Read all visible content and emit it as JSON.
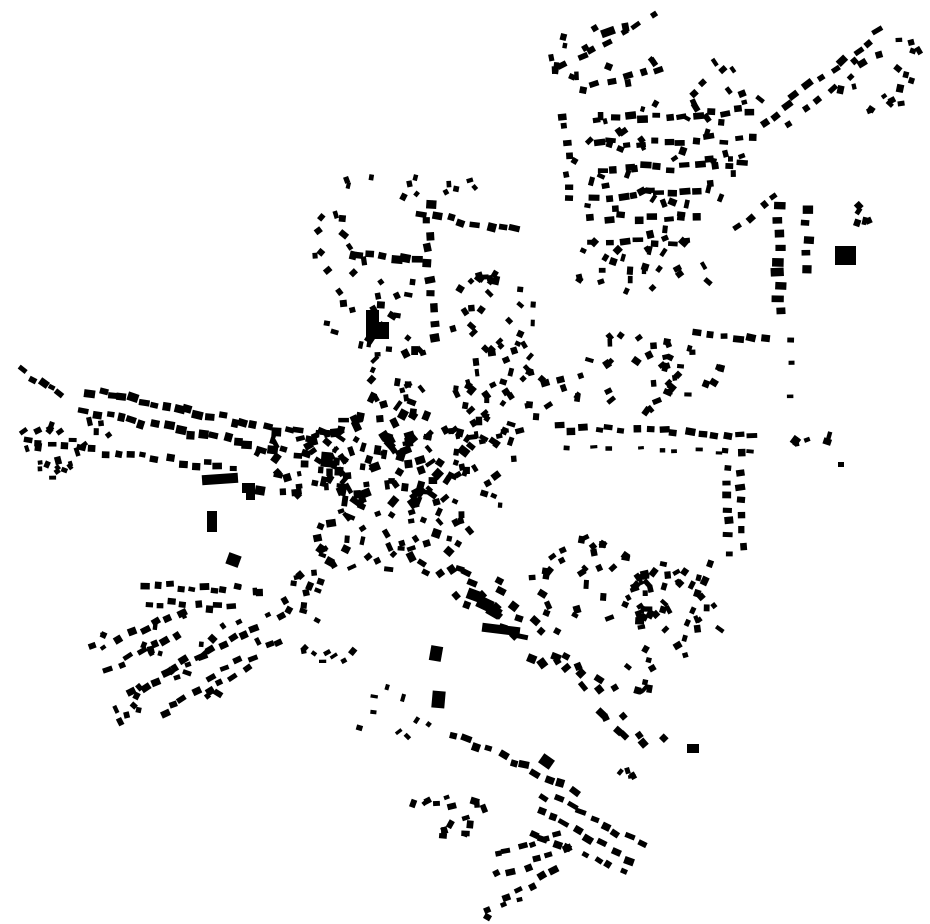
{
  "meta": {
    "title": "Figure-ground building footprint map",
    "canvas": {
      "width": 930,
      "height": 924
    },
    "colors": {
      "background": "#ffffff",
      "building": "#000000"
    },
    "seed": 20240707
  },
  "map": {
    "landmarks": [
      [
        366,
        310,
        13,
        14,
        0
      ],
      [
        366,
        322,
        23,
        17,
        0
      ],
      [
        835,
        246,
        21,
        19,
        0
      ],
      [
        202,
        474,
        36,
        10,
        -4
      ],
      [
        207,
        511,
        10,
        21,
        0
      ],
      [
        467,
        590,
        16,
        11,
        20
      ],
      [
        477,
        598,
        16,
        12,
        25
      ],
      [
        487,
        606,
        14,
        11,
        30
      ],
      [
        482,
        625,
        38,
        9,
        7
      ],
      [
        515,
        634,
        13,
        5,
        12
      ],
      [
        430,
        646,
        12,
        15,
        10
      ],
      [
        432,
        691,
        13,
        17,
        5
      ],
      [
        321,
        452,
        10,
        15,
        5
      ],
      [
        242,
        483,
        13,
        10,
        0
      ],
      [
        255,
        486,
        10,
        9,
        10
      ],
      [
        246,
        492,
        9,
        8,
        0
      ],
      [
        227,
        554,
        13,
        12,
        20
      ],
      [
        484,
        914,
        7,
        6,
        30
      ],
      [
        687,
        744,
        12,
        9,
        0
      ],
      [
        838,
        462,
        6,
        5,
        0
      ],
      [
        601,
        28,
        14,
        8,
        -20
      ],
      [
        540,
        756,
        13,
        11,
        35
      ]
    ],
    "streets": [
      {
        "p": [
          22,
          371,
          60,
          396
        ],
        "n": 5,
        "s": [
          8,
          6
        ]
      },
      {
        "p": [
          90,
          391,
          310,
          436
        ],
        "n": 21,
        "s": [
          9,
          7
        ]
      },
      {
        "p": [
          85,
          412,
          308,
          456
        ],
        "n": 20,
        "s": [
          9,
          7
        ]
      },
      {
        "p": [
          28,
          441,
          232,
          468
        ],
        "n": 17,
        "s": [
          8,
          6
        ]
      },
      {
        "p": [
          428,
          205,
          432,
          335
        ],
        "n": 10,
        "s": [
          8,
          9
        ],
        "jr": 14
      },
      {
        "p": [
          358,
          252,
          420,
          260
        ],
        "n": 6,
        "s": [
          9,
          7
        ]
      },
      {
        "p": [
          425,
          212,
          516,
          232
        ],
        "n": 8,
        "s": [
          9,
          7
        ]
      },
      {
        "p": [
          565,
          63,
          652,
          15
        ],
        "n": 7,
        "s": [
          8,
          6
        ]
      },
      {
        "p": [
          596,
          86,
          658,
          72
        ],
        "n": 5,
        "s": [
          8,
          6
        ]
      },
      {
        "p": [
          600,
          119,
          752,
          110
        ],
        "n": 12,
        "s": [
          9,
          6
        ]
      },
      {
        "p": [
          598,
          144,
          750,
          138
        ],
        "n": 12,
        "s": [
          9,
          6
        ]
      },
      {
        "p": [
          600,
          170,
          742,
          164
        ],
        "n": 11,
        "s": [
          9,
          6
        ]
      },
      {
        "p": [
          596,
          196,
          700,
          191
        ],
        "n": 9,
        "s": [
          9,
          6
        ]
      },
      {
        "p": [
          592,
          218,
          700,
          216
        ],
        "n": 8,
        "s": [
          9,
          6
        ]
      },
      {
        "p": [
          592,
          243,
          688,
          241
        ],
        "n": 7,
        "s": [
          9,
          6
        ]
      },
      {
        "p": [
          563,
          115,
          571,
          200
        ],
        "n": 7,
        "s": [
          7,
          7
        ]
      },
      {
        "p": [
          762,
          124,
          878,
          33
        ],
        "n": 11,
        "s": [
          9,
          6
        ]
      },
      {
        "p": [
          792,
          122,
          862,
          67
        ],
        "n": 6,
        "s": [
          8,
          6
        ]
      },
      {
        "p": [
          779,
          207,
          779,
          313
        ],
        "n": 9,
        "s": [
          11,
          7
        ],
        "perp": true,
        "jp": 2,
        "jr": 4
      },
      {
        "p": [
          807,
          210,
          807,
          268
        ],
        "n": 5,
        "s": [
          10,
          7
        ],
        "perp": true,
        "jp": 2,
        "jr": 4
      },
      {
        "p": [
          741,
          226,
          776,
          196
        ],
        "n": 4,
        "s": [
          8,
          6
        ]
      },
      {
        "p": [
          700,
          332,
          766,
          339
        ],
        "n": 6,
        "s": [
          9,
          6
        ]
      },
      {
        "p": [
          558,
          428,
          752,
          436
        ],
        "n": 16,
        "s": [
          9,
          6
        ],
        "jp": 3
      },
      {
        "p": [
          570,
          447,
          745,
          453
        ],
        "n": 9,
        "s": [
          6,
          4
        ],
        "jp": 2
      },
      {
        "p": [
          727,
          452,
          729,
          552
        ],
        "n": 8,
        "s": [
          8,
          6
        ],
        "perp": true,
        "jp": 2
      },
      {
        "p": [
          741,
          455,
          742,
          545
        ],
        "n": 7,
        "s": [
          8,
          6
        ],
        "perp": true,
        "jp": 2
      },
      {
        "p": [
          706,
          566,
          682,
          636
        ],
        "n": 6,
        "s": [
          8,
          6
        ]
      },
      {
        "p": [
          455,
          735,
          573,
          788
        ],
        "n": 11,
        "s": [
          9,
          7
        ],
        "jr": 15
      },
      {
        "p": [
          545,
          795,
          640,
          843
        ],
        "n": 9,
        "s": [
          9,
          6
        ]
      },
      {
        "p": [
          538,
          813,
          630,
          858
        ],
        "n": 8,
        "s": [
          9,
          6
        ]
      },
      {
        "p": [
          533,
          831,
          620,
          873
        ],
        "n": 8,
        "s": [
          8,
          6
        ]
      },
      {
        "p": [
          496,
          855,
          560,
          835
        ],
        "n": 6,
        "s": [
          8,
          6
        ]
      },
      {
        "p": [
          500,
          875,
          565,
          852
        ],
        "n": 6,
        "s": [
          8,
          6
        ]
      },
      {
        "p": [
          505,
          895,
          558,
          872
        ],
        "n": 5,
        "s": [
          8,
          6
        ]
      },
      {
        "p": [
          487,
          908,
          520,
          899
        ],
        "n": 3,
        "s": [
          7,
          5
        ]
      },
      {
        "p": [
          146,
          585,
          224,
          589
        ],
        "n": 8,
        "s": [
          8,
          6
        ]
      },
      {
        "p": [
          148,
          604,
          232,
          607
        ],
        "n": 8,
        "s": [
          8,
          6
        ]
      },
      {
        "p": [
          118,
          640,
          182,
          611
        ],
        "n": 6,
        "s": [
          8,
          6
        ]
      },
      {
        "p": [
          108,
          668,
          176,
          636
        ],
        "n": 7,
        "s": [
          8,
          6
        ]
      },
      {
        "p": [
          130,
          692,
          202,
          658
        ],
        "n": 7,
        "s": [
          8,
          6
        ]
      },
      {
        "p": [
          162,
          712,
          232,
          677
        ],
        "n": 7,
        "s": [
          8,
          6
        ]
      },
      {
        "p": [
          186,
          662,
          256,
          629
        ],
        "n": 7,
        "s": [
          8,
          6
        ]
      },
      {
        "p": [
          212,
          674,
          282,
          642
        ],
        "n": 6,
        "s": [
          8,
          6
        ]
      },
      {
        "p": [
          791,
          334,
          791,
          398
        ],
        "n": 3,
        "s": [
          4,
          6
        ],
        "jp": 1,
        "jr": 3
      },
      {
        "p": [
          425,
          550,
          565,
          655
        ],
        "n": 28,
        "s": [
          8,
          7
        ],
        "jp": 26,
        "jr": 20
      },
      {
        "p": [
          565,
          655,
          650,
          748
        ],
        "n": 16,
        "s": [
          8,
          7
        ],
        "jp": 20,
        "jr": 20
      }
    ],
    "clusters": [
      {
        "c": [
          390,
          455
        ],
        "r": [
          75,
          60
        ],
        "n": 105,
        "s": [
          5,
          11
        ]
      },
      {
        "c": [
          370,
          540
        ],
        "r": [
          58,
          35
        ],
        "n": 32,
        "s": [
          5,
          10
        ]
      },
      {
        "c": [
          300,
          460
        ],
        "r": [
          45,
          38
        ],
        "n": 26,
        "s": [
          5,
          10
        ]
      },
      {
        "c": [
          445,
          523
        ],
        "r": [
          30,
          25
        ],
        "n": 12,
        "s": [
          5,
          9
        ]
      },
      {
        "c": [
          405,
          373
        ],
        "r": [
          40,
          26
        ],
        "n": 14,
        "s": [
          5,
          9
        ]
      },
      {
        "c": [
          490,
          468
        ],
        "r": [
          35,
          40
        ],
        "n": 15,
        "s": [
          5,
          9
        ]
      },
      {
        "c": [
          370,
          300
        ],
        "r": [
          58,
          52
        ],
        "n": 22,
        "s": [
          5,
          9
        ]
      },
      {
        "c": [
          498,
          310
        ],
        "r": [
          50,
          45
        ],
        "n": 28,
        "s": [
          5,
          9
        ]
      },
      {
        "c": [
          360,
          182
        ],
        "r": [
          18,
          8
        ],
        "n": 3,
        "s": [
          5,
          8
        ]
      },
      {
        "c": [
          462,
          185
        ],
        "r": [
          14,
          9
        ],
        "n": 3,
        "s": [
          5,
          8
        ]
      },
      {
        "c": [
          335,
          245
        ],
        "r": [
          26,
          34
        ],
        "n": 10,
        "s": [
          5,
          9
        ]
      },
      {
        "c": [
          420,
          190
        ],
        "r": [
          34,
          18
        ],
        "n": 7,
        "s": [
          5,
          8
        ]
      },
      {
        "c": [
          600,
          60
        ],
        "r": [
          55,
          50
        ],
        "n": 16,
        "s": [
          5,
          9
        ]
      },
      {
        "c": [
          655,
          165
        ],
        "r": [
          88,
          72
        ],
        "n": 40,
        "s": [
          5,
          9
        ]
      },
      {
        "c": [
          640,
          272
        ],
        "r": [
          70,
          45
        ],
        "n": 28,
        "s": [
          5,
          9
        ]
      },
      {
        "c": [
          722,
          92
        ],
        "r": [
          40,
          34
        ],
        "n": 13,
        "s": [
          5,
          9
        ]
      },
      {
        "c": [
          876,
          90
        ],
        "r": [
          38,
          36
        ],
        "n": 13,
        "s": [
          5,
          9
        ]
      },
      {
        "c": [
          906,
          48
        ],
        "r": [
          18,
          28
        ],
        "n": 5,
        "s": [
          4,
          8
        ]
      },
      {
        "c": [
          858,
          215
        ],
        "r": [
          17,
          14
        ],
        "n": 5,
        "s": [
          5,
          9
        ]
      },
      {
        "c": [
          640,
          372
        ],
        "r": [
          84,
          40
        ],
        "n": 42,
        "s": [
          5,
          9
        ]
      },
      {
        "c": [
          818,
          442
        ],
        "r": [
          25,
          10
        ],
        "n": 6,
        "s": [
          5,
          9
        ]
      },
      {
        "c": [
          505,
          392
        ],
        "r": [
          52,
          46
        ],
        "n": 36,
        "s": [
          5,
          9
        ]
      },
      {
        "c": [
          480,
          430
        ],
        "r": [
          40,
          22
        ],
        "n": 14,
        "s": [
          5,
          9
        ]
      },
      {
        "c": [
          590,
          580
        ],
        "r": [
          68,
          45
        ],
        "n": 32,
        "s": [
          5,
          9
        ]
      },
      {
        "c": [
          648,
          600
        ],
        "r": [
          25,
          30
        ],
        "n": 11,
        "s": [
          5,
          9
        ]
      },
      {
        "c": [
          645,
          675
        ],
        "r": [
          22,
          18
        ],
        "n": 8,
        "s": [
          5,
          9
        ]
      },
      {
        "c": [
          635,
          772
        ],
        "r": [
          20,
          12
        ],
        "n": 4,
        "s": [
          4,
          8
        ]
      },
      {
        "c": [
          675,
          610
        ],
        "r": [
          52,
          48
        ],
        "n": 30,
        "s": [
          5,
          9
        ]
      },
      {
        "c": [
          450,
          815
        ],
        "r": [
          40,
          32
        ],
        "n": 17,
        "s": [
          5,
          9
        ]
      },
      {
        "c": [
          395,
          710
        ],
        "r": [
          45,
          35
        ],
        "n": 9,
        "s": [
          4,
          8
        ]
      },
      {
        "c": [
          200,
          655
        ],
        "r": [
          68,
          45
        ],
        "n": 18,
        "s": [
          5,
          9
        ]
      },
      {
        "c": [
          120,
          700
        ],
        "r": [
          28,
          24
        ],
        "n": 7,
        "s": [
          5,
          8
        ]
      },
      {
        "c": [
          280,
          590
        ],
        "r": [
          45,
          30
        ],
        "n": 18,
        "s": [
          5,
          9
        ]
      },
      {
        "c": [
          100,
          640
        ],
        "r": [
          12,
          16
        ],
        "n": 4,
        "s": [
          4,
          8
        ]
      },
      {
        "c": [
          65,
          440
        ],
        "r": [
          45,
          30
        ],
        "n": 20,
        "s": [
          5,
          9
        ]
      },
      {
        "c": [
          55,
          468
        ],
        "r": [
          28,
          10
        ],
        "n": 5,
        "s": [
          4,
          8
        ]
      },
      {
        "c": [
          330,
          640
        ],
        "r": [
          30,
          25
        ],
        "n": 9,
        "s": [
          4,
          8
        ]
      }
    ]
  }
}
